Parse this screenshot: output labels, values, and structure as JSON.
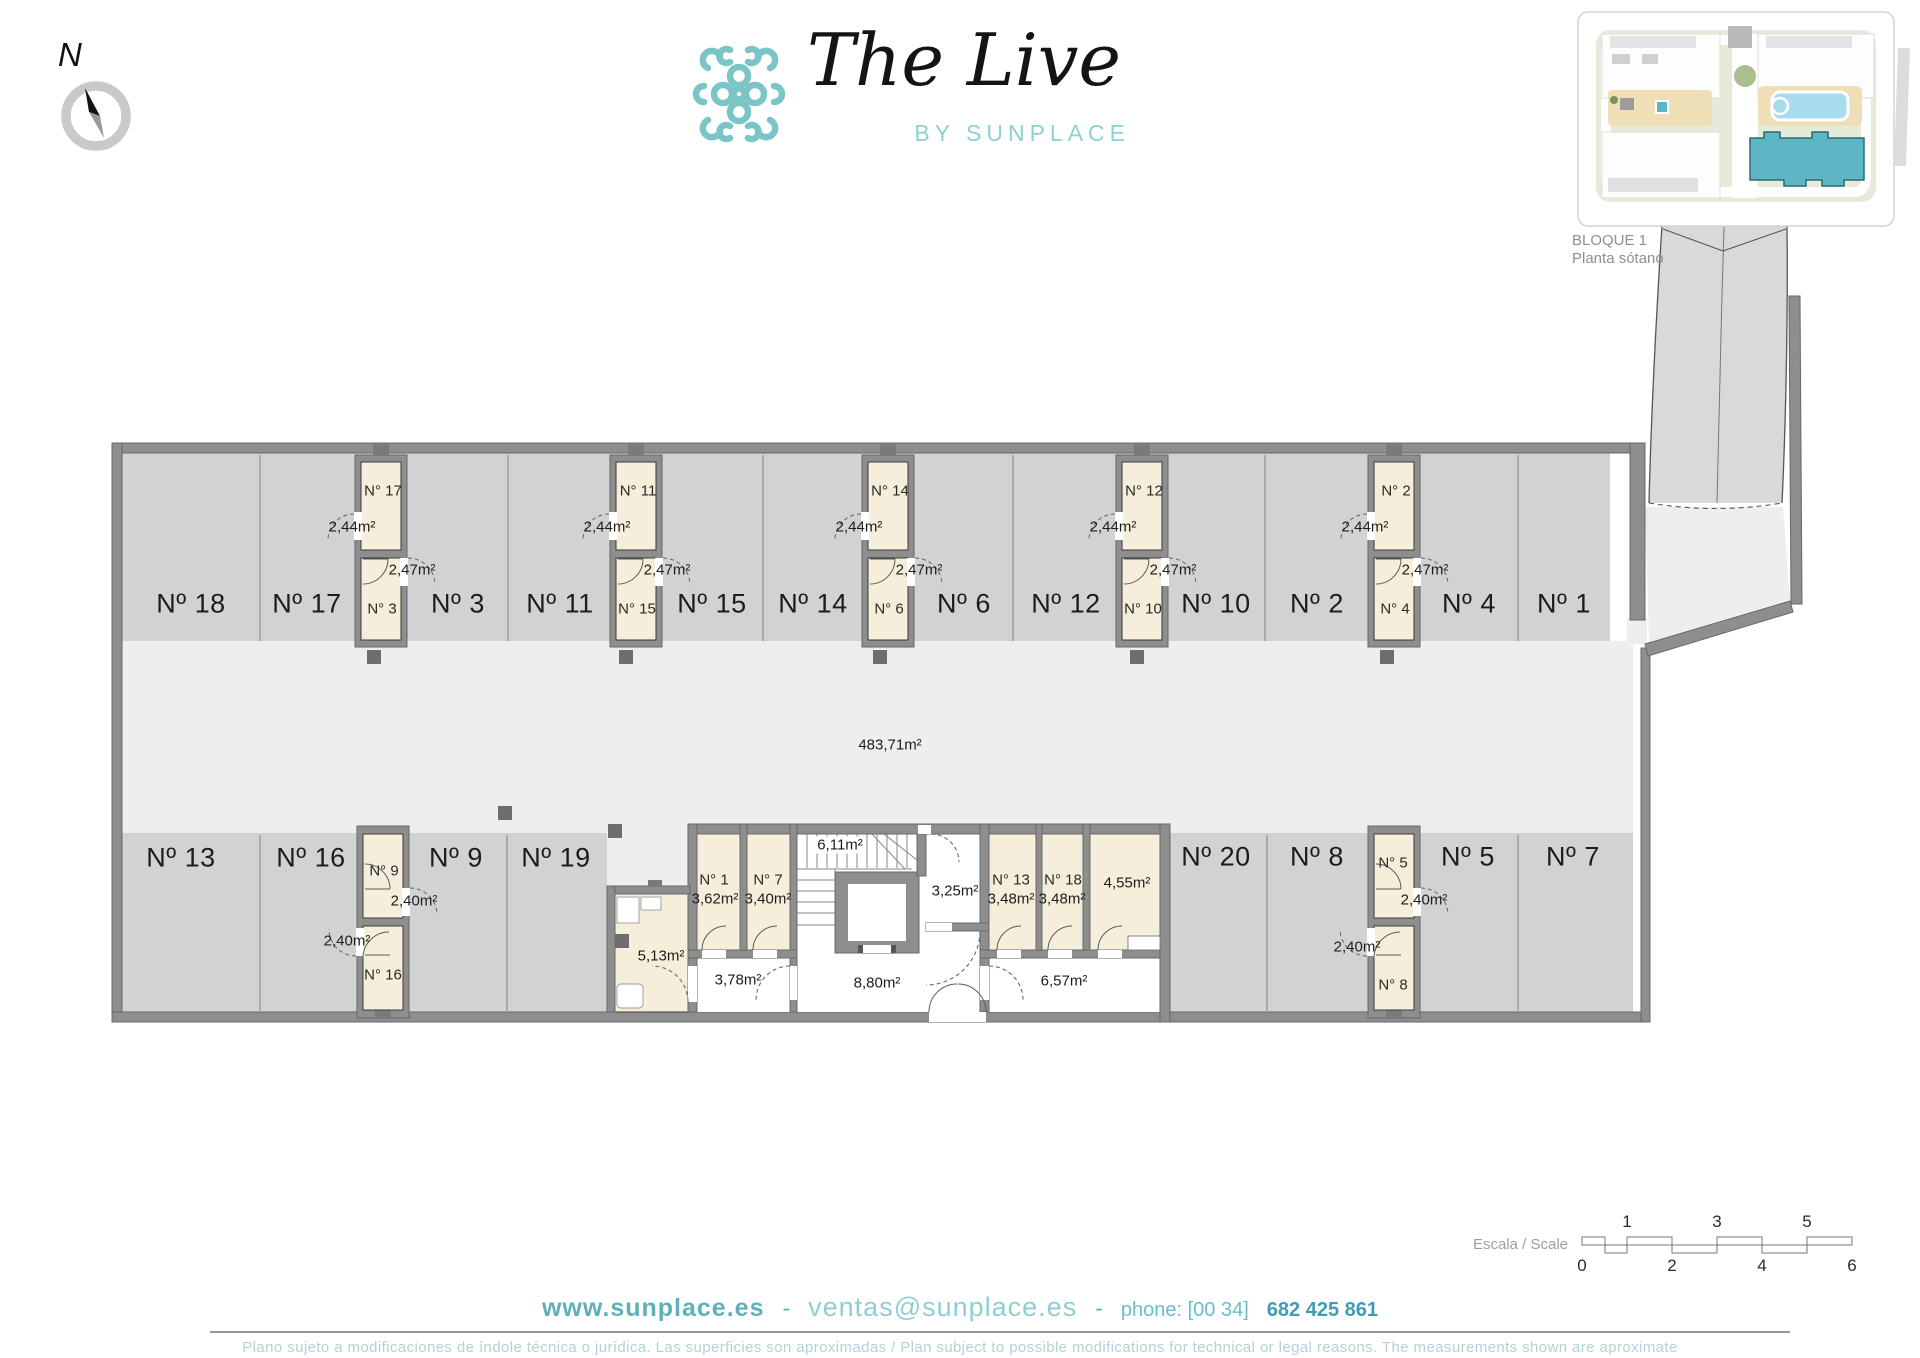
{
  "brand": {
    "name": "The Live",
    "tagline": "BY SUNPLACE"
  },
  "compass": {
    "north_label": "N"
  },
  "inset": {
    "caption_line1": "BLOQUE 1",
    "caption_line2": "Planta sótano"
  },
  "plan": {
    "aisle_area_label": "483,71m²",
    "top_parking": [
      {
        "label": "Nº 18"
      },
      {
        "label": "Nº 17"
      },
      {
        "label": "Nº 3"
      },
      {
        "label": "Nº 11"
      },
      {
        "label": "Nº 15"
      },
      {
        "label": "Nº 14"
      },
      {
        "label": "Nº 6"
      },
      {
        "label": "Nº 12"
      },
      {
        "label": "Nº 10"
      },
      {
        "label": "Nº 2"
      },
      {
        "label": "Nº 4"
      },
      {
        "label": "Nº 1"
      }
    ],
    "top_storage": [
      {
        "top_number": "N° 17",
        "top_area": "2,44m²",
        "bottom_number": "N° 3",
        "bottom_area": "2,47m²"
      },
      {
        "top_number": "N° 11",
        "top_area": "2,44m²",
        "bottom_number": "N° 15",
        "bottom_area": "2,47m²"
      },
      {
        "top_number": "N° 14",
        "top_area": "2,44m²",
        "bottom_number": "N° 6",
        "bottom_area": "2,47m²"
      },
      {
        "top_number": "N° 12",
        "top_area": "2,44m²",
        "bottom_number": "N° 10",
        "bottom_area": "2,47m²"
      },
      {
        "top_number": "N° 2",
        "top_area": "2,44m²",
        "bottom_number": "N° 4",
        "bottom_area": "2,47m²"
      }
    ],
    "bottom_parking": [
      {
        "label": "Nº 13"
      },
      {
        "label": "Nº 16"
      },
      {
        "label": "Nº 9"
      },
      {
        "label": "Nº 19"
      },
      {
        "label": "Nº 20"
      },
      {
        "label": "Nº 8"
      },
      {
        "label": "Nº 5"
      },
      {
        "label": "Nº 7"
      }
    ],
    "bottom_storage": [
      {
        "top_number": "N° 9",
        "top_area": "2,40m²",
        "bottom_number": "N° 16",
        "bottom_area": "2,40m²"
      },
      {
        "top_number": "N° 5",
        "top_area": "2,40m²",
        "bottom_number": "N° 8",
        "bottom_area": "2,40m²"
      }
    ],
    "core": {
      "storage_n1": {
        "number": "N° 1",
        "area": "3,62m²"
      },
      "storage_n7": {
        "number": "N° 7",
        "area": "3,40m²"
      },
      "stairs_area": "6,11m²",
      "room_325": "3,25m²",
      "corridor_378": "3,78m²",
      "lobby_880": "8,80m²",
      "room_513": "5,13m²",
      "storage_n13": {
        "number": "N° 13",
        "area": "3,48m²"
      },
      "storage_n18": {
        "number": "N° 18",
        "area": "3,48m²"
      },
      "storage_455": "4,55m²",
      "corridor_657": "6,57m²"
    }
  },
  "scale_bar": {
    "label": "Escala / Scale",
    "ticks_above": [
      "1",
      "3",
      "5"
    ],
    "ticks_below": [
      "0",
      "2",
      "4",
      "6"
    ]
  },
  "footer": {
    "website": "www.sunplace.es",
    "sep1": "-",
    "email": "ventas@sunplace.es",
    "sep2": "-",
    "phone_label": "phone: [00 34]",
    "phone_number": "682 425 861",
    "disclaimer": "Plano sujeto a modificaciones de índole técnica o jurídica. Las superficies son aproximadas / Plan subject to possible modifications for technical or legal reasons. The measurements shown are aproximate"
  },
  "colors": {
    "accent_teal": "#7cc5c7",
    "storage_beige": "#f5eedb",
    "stall_gray": "#d2d2d2",
    "aisle_gray": "#eeeeee",
    "wall_gray": "#8e8e8e",
    "highlight_building": "#5eb6c5"
  }
}
